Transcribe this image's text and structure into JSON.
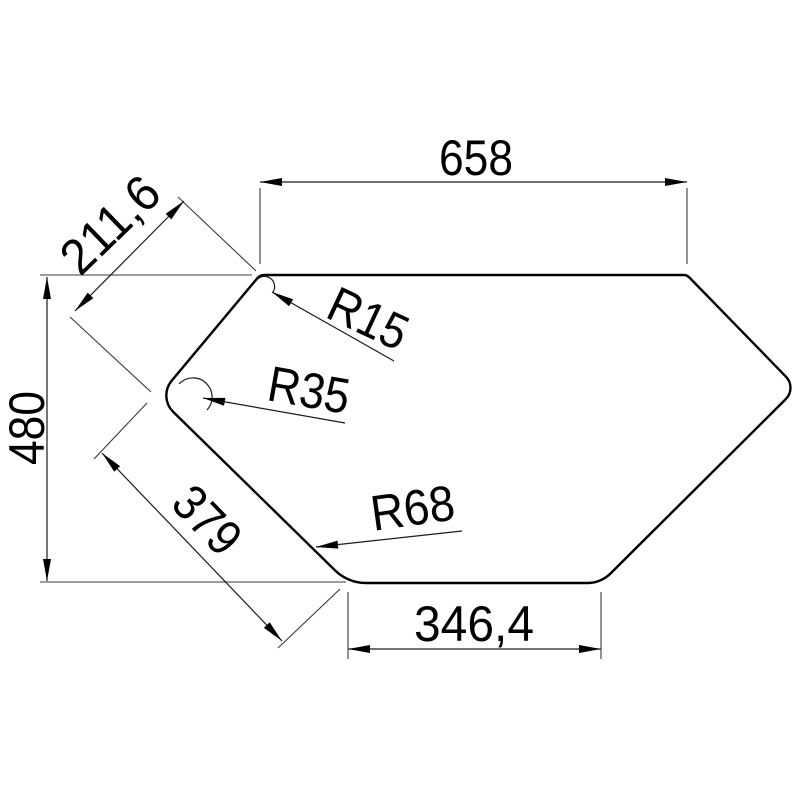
{
  "drawing": {
    "kind": "technical-dimension-drawing",
    "subject": "hexagonal corner-sink cutout outline with dimensions",
    "background_color": "#ffffff",
    "line_color": "#000000",
    "dimensions": {
      "top_width": "658",
      "upper_left_edge": "211,6",
      "overall_height": "480",
      "lower_left_edge": "379",
      "bottom_width": "346,4"
    },
    "radius_labels": {
      "top_left_corner": "R15",
      "left_corner": "R35",
      "bottom_left_corner": "R68"
    }
  }
}
